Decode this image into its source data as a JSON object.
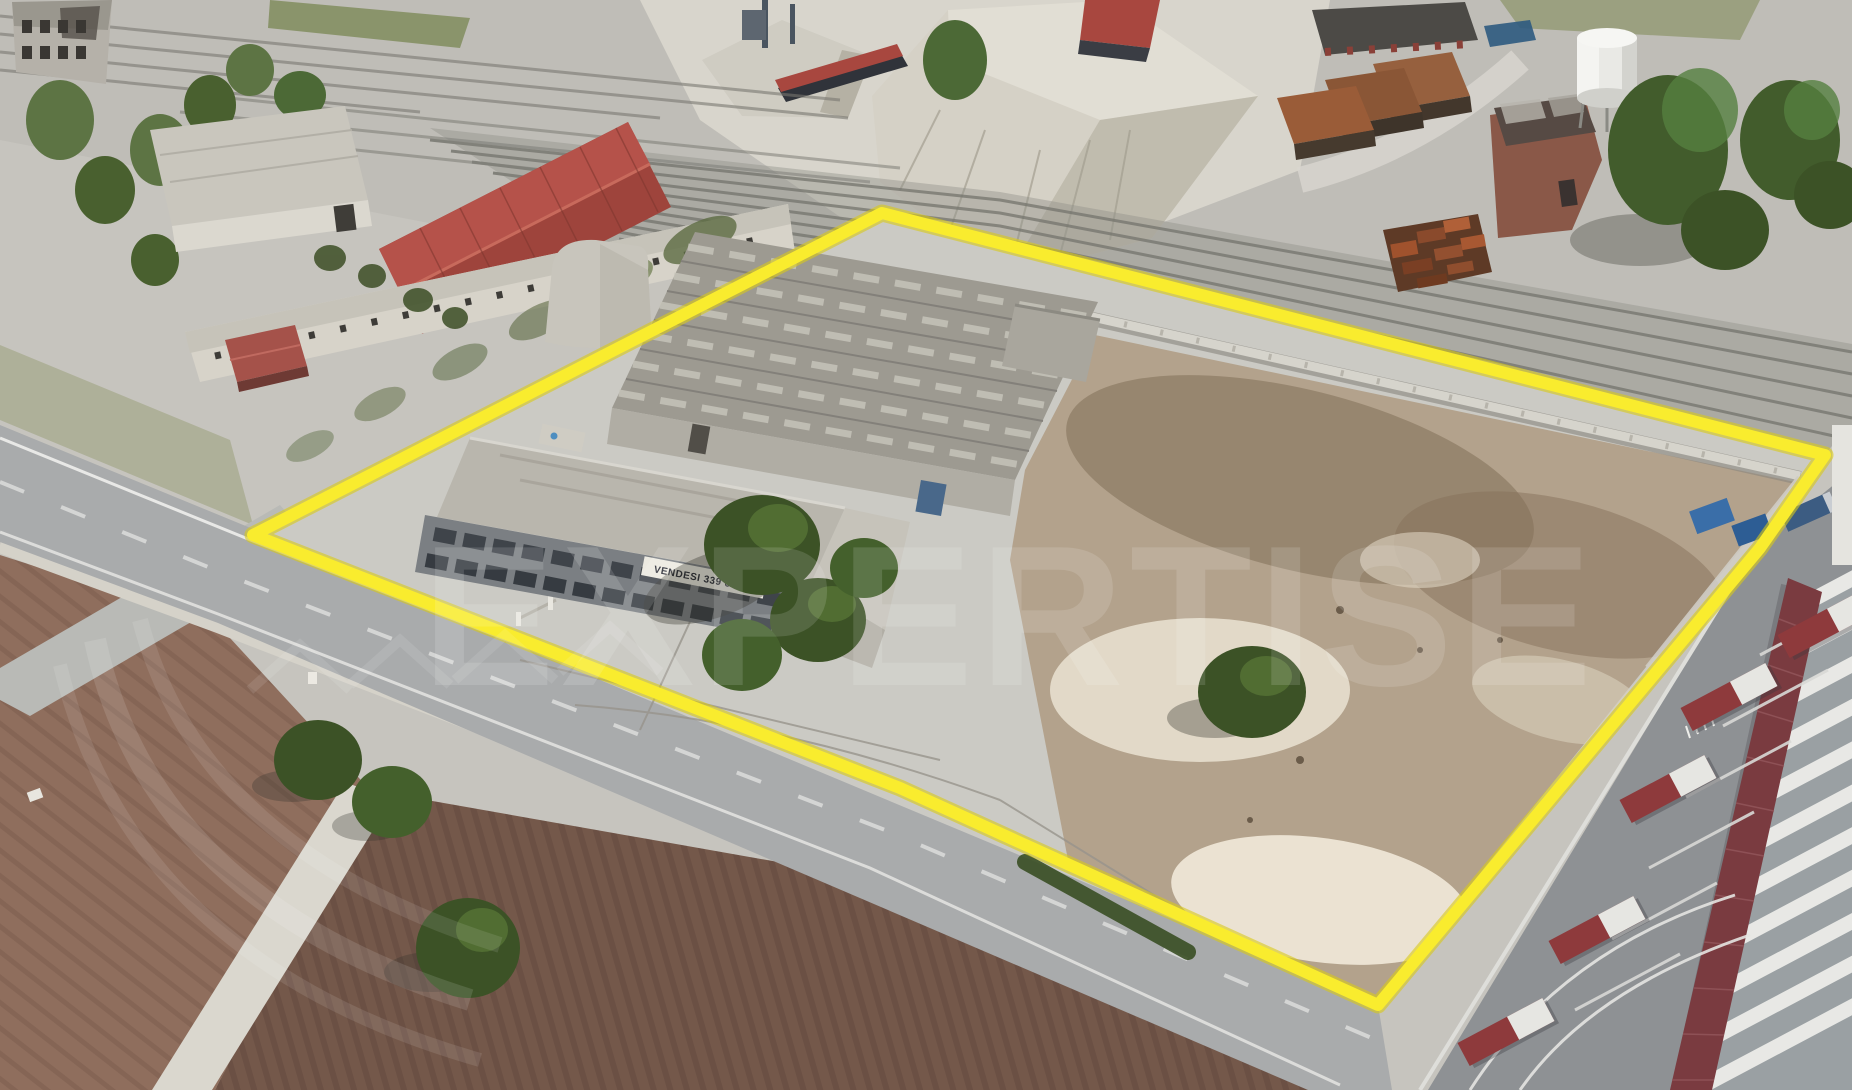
{
  "scene_description": "Oblique aerial (3D satellite style) photo of an abandoned industrial property outlined with a yellow parcel boundary; railway sidings and gravel piles behind, plowed fields and a road in front, truck depot lower right, white water tower upper right.",
  "watermark": {
    "text": "EXPERTISE",
    "color": "#ffffff"
  },
  "property": {
    "banner_text": "VENDESI 339 634…",
    "outline_color": "#f9ec2e"
  },
  "palette": {
    "concrete": "#cbcac4",
    "road": "#a9abac",
    "field_left": "#8f6e5d",
    "field_right": "#74584a",
    "dirt_yard": "#b3a28c",
    "tree_dark": "#3c5226",
    "tree_light": "#567436",
    "roof_red": "#b5524a",
    "truck_red": "#8e3a3c",
    "canopy_maroon": "#7a3b40",
    "rail_dark": "#77766f",
    "water_tower_white": "#f2f2ef",
    "dumpster_blue": "#3a6ea8"
  }
}
